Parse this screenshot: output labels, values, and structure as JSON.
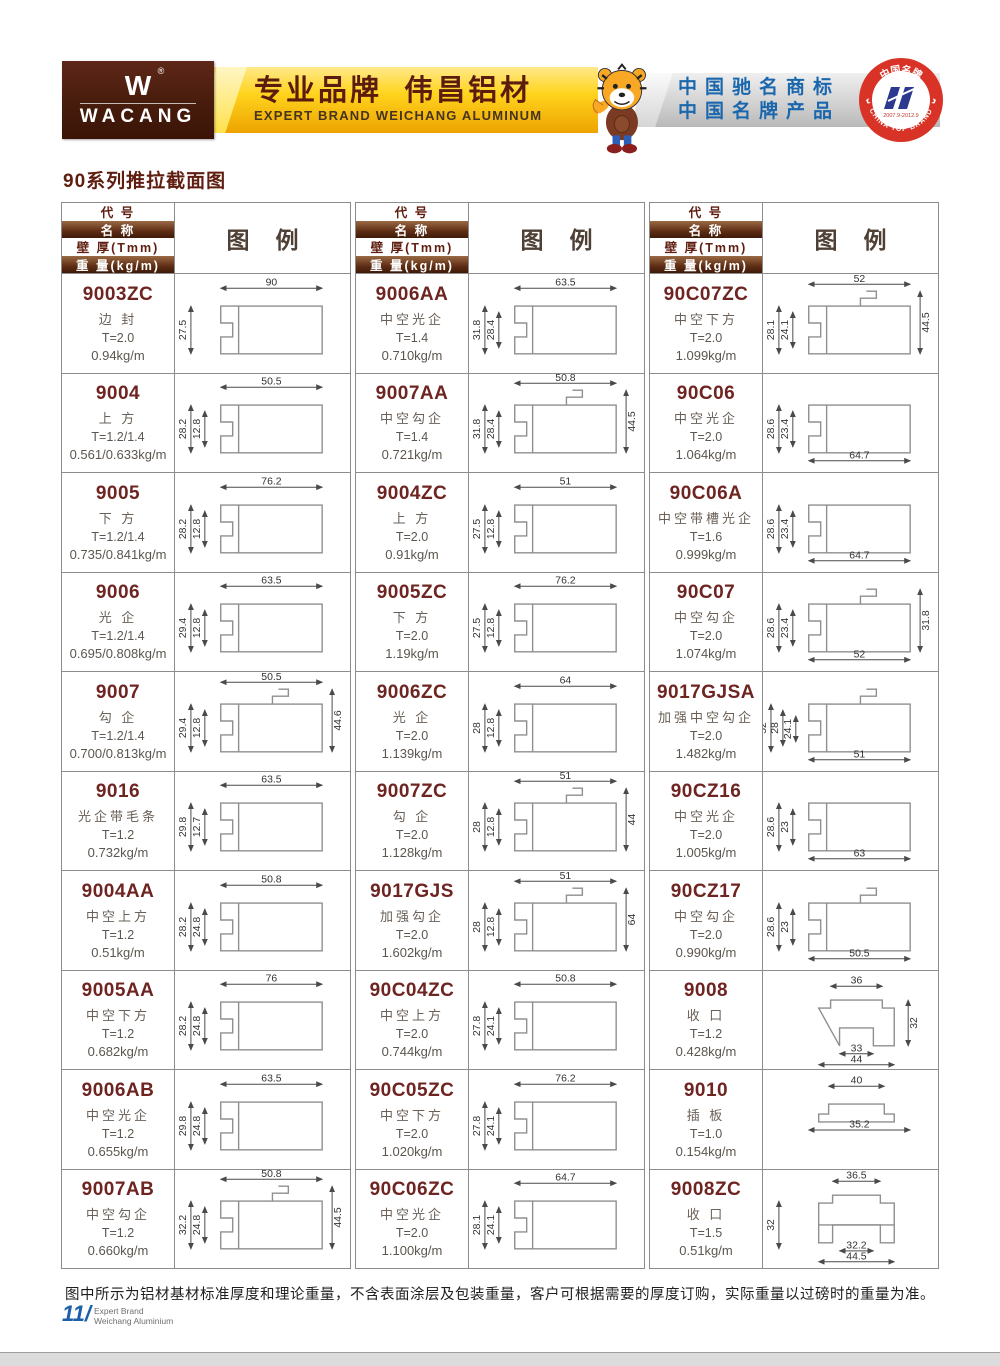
{
  "banner": {
    "logo": {
      "brand": "WACANG",
      "reg": "®"
    },
    "slogan_cn": "专业品牌  伟昌铝材",
    "slogan_en": "EXPERT BRAND WEICHANG ALUMINUM",
    "honors": [
      "中国驰名商标",
      "中国名牌产品"
    ],
    "badge": {
      "top": "中国名牌",
      "bottom": "CHINA TOP BRAND",
      "years": "2007.9-2012.9"
    }
  },
  "section_title": "90系列推拉截面图",
  "table": {
    "headers": {
      "code": "代  号",
      "name": "名  称",
      "thickness": "壁 厚(Tmm)",
      "weight": "重 量(kg/m)",
      "legend": "图例"
    },
    "columns": [
      {
        "products": [
          {
            "code": "9003ZC",
            "name": "边 封",
            "thickness": "T=2.0",
            "weight": "0.94kg/m",
            "shape": "frame",
            "dims": {
              "top": "90",
              "left": [
                "27.5"
              ]
            }
          },
          {
            "code": "9004",
            "name": "上 方",
            "thickness": "T=1.2/1.4",
            "weight": "0.561/0.633kg/m",
            "shape": "frame",
            "dims": {
              "top": "50.5",
              "left": [
                "28.2",
                "12.8"
              ]
            }
          },
          {
            "code": "9005",
            "name": "下 方",
            "thickness": "T=1.2/1.4",
            "weight": "0.735/0.841kg/m",
            "shape": "frame",
            "dims": {
              "top": "76.2",
              "left": [
                "28.2",
                "12.8"
              ]
            }
          },
          {
            "code": "9006",
            "name": "光 企",
            "thickness": "T=1.2/1.4",
            "weight": "0.695/0.808kg/m",
            "shape": "frame",
            "dims": {
              "top": "63.5",
              "left": [
                "29.4",
                "12.8"
              ]
            }
          },
          {
            "code": "9007",
            "name": "勾 企",
            "thickness": "T=1.2/1.4",
            "weight": "0.700/0.813kg/m",
            "shape": "hook",
            "dims": {
              "top": "50.5",
              "left": [
                "29.4",
                "12.8"
              ],
              "right": "44.6"
            }
          },
          {
            "code": "9016",
            "name": "光企带毛条",
            "thickness": "T=1.2",
            "weight": "0.732kg/m",
            "shape": "frame",
            "dims": {
              "top": "63.5",
              "left": [
                "29.8",
                "12.7"
              ]
            }
          },
          {
            "code": "9004AA",
            "name": "中空上方",
            "thickness": "T=1.2",
            "weight": "0.51kg/m",
            "shape": "frame",
            "dims": {
              "top": "50.8",
              "left": [
                "28.2",
                "24.8"
              ]
            }
          },
          {
            "code": "9005AA",
            "name": "中空下方",
            "thickness": "T=1.2",
            "weight": "0.682kg/m",
            "shape": "frame",
            "dims": {
              "top": "76",
              "left": [
                "28.2",
                "24.8"
              ]
            }
          },
          {
            "code": "9006AB",
            "name": "中空光企",
            "thickness": "T=1.2",
            "weight": "0.655kg/m",
            "shape": "frame",
            "dims": {
              "top": "63.5",
              "left": [
                "29.8",
                "24.8"
              ]
            }
          },
          {
            "code": "9007AB",
            "name": "中空勾企",
            "thickness": "T=1.2",
            "weight": "0.660kg/m",
            "shape": "hook",
            "dims": {
              "top": "50.8",
              "left": [
                "32.2",
                "24.8"
              ],
              "right": "44.5"
            }
          }
        ]
      },
      {
        "products": [
          {
            "code": "9006AA",
            "name": "中空光企",
            "thickness": "T=1.4",
            "weight": "0.710kg/m",
            "shape": "frame",
            "dims": {
              "top": "63.5",
              "left": [
                "31.8",
                "28.4"
              ]
            }
          },
          {
            "code": "9007AA",
            "name": "中空勾企",
            "thickness": "T=1.4",
            "weight": "0.721kg/m",
            "shape": "hook",
            "dims": {
              "top": "50.8",
              "left": [
                "31.8",
                "28.4"
              ],
              "right": "44.5"
            }
          },
          {
            "code": "9004ZC",
            "name": "上 方",
            "thickness": "T=2.0",
            "weight": "0.91kg/m",
            "shape": "frame",
            "dims": {
              "top": "51",
              "left": [
                "27.5",
                "12.8"
              ]
            }
          },
          {
            "code": "9005ZC",
            "name": "下 方",
            "thickness": "T=2.0",
            "weight": "1.19kg/m",
            "shape": "frame",
            "dims": {
              "top": "76.2",
              "left": [
                "27.5",
                "12.8"
              ]
            }
          },
          {
            "code": "9006ZC",
            "name": "光 企",
            "thickness": "T=2.0",
            "weight": "1.139kg/m",
            "shape": "frame",
            "dims": {
              "top": "64",
              "left": [
                "28",
                "12.8"
              ]
            }
          },
          {
            "code": "9007ZC",
            "name": "勾 企",
            "thickness": "T=2.0",
            "weight": "1.128kg/m",
            "shape": "hook",
            "dims": {
              "top": "51",
              "left": [
                "28",
                "12.8"
              ],
              "right": "44"
            }
          },
          {
            "code": "9017GJS",
            "name": "加强勾企",
            "thickness": "T=2.0",
            "weight": "1.602kg/m",
            "shape": "hook",
            "dims": {
              "top": "51",
              "left": [
                "28",
                "12.8"
              ],
              "right": "64"
            }
          },
          {
            "code": "90C04ZC",
            "name": "中空上方",
            "thickness": "T=2.0",
            "weight": "0.744kg/m",
            "shape": "frame",
            "dims": {
              "top": "50.8",
              "left": [
                "27.8",
                "24.1"
              ]
            }
          },
          {
            "code": "90C05ZC",
            "name": "中空下方",
            "thickness": "T=2.0",
            "weight": "1.020kg/m",
            "shape": "frame",
            "dims": {
              "top": "76.2",
              "left": [
                "27.8",
                "24.1"
              ]
            }
          },
          {
            "code": "90C06ZC",
            "name": "中空光企",
            "thickness": "T=2.0",
            "weight": "1.100kg/m",
            "shape": "frame",
            "dims": {
              "top": "64.7",
              "left": [
                "28.1",
                "24.1"
              ]
            }
          }
        ]
      },
      {
        "products": [
          {
            "code": "90C07ZC",
            "name": "中空下方",
            "thickness": "T=2.0",
            "weight": "1.099kg/m",
            "shape": "hook",
            "dims": {
              "top": "52",
              "left": [
                "28.1",
                "24.1"
              ],
              "right": "44.5"
            }
          },
          {
            "code": "90C06",
            "name": "中空光企",
            "thickness": "T=2.0",
            "weight": "1.064kg/m",
            "shape": "frame",
            "dims": {
              "left": [
                "28.6",
                "23.4"
              ],
              "bottom": [
                "64.7"
              ]
            }
          },
          {
            "code": "90C06A",
            "name": "中空带槽光企",
            "thickness": "T=1.6",
            "weight": "0.999kg/m",
            "shape": "frame",
            "dims": {
              "left": [
                "28.6",
                "23.4"
              ],
              "bottom": [
                "64.7"
              ]
            }
          },
          {
            "code": "90C07",
            "name": "中空勾企",
            "thickness": "T=2.0",
            "weight": "1.074kg/m",
            "shape": "hook",
            "dims": {
              "left": [
                "28.6",
                "23.4"
              ],
              "right": "31.8",
              "bottom": [
                "52"
              ]
            }
          },
          {
            "code": "9017GJSA",
            "name": "加强中空勾企",
            "thickness": "T=2.0",
            "weight": "1.482kg/m",
            "shape": "hook",
            "dims": {
              "left": [
                "52",
                "28",
                "24.1"
              ],
              "bottom": [
                "51"
              ]
            }
          },
          {
            "code": "90CZ16",
            "name": "中空光企",
            "thickness": "T=2.0",
            "weight": "1.005kg/m",
            "shape": "frame",
            "dims": {
              "left": [
                "28.6",
                "23"
              ],
              "bottom": [
                "63"
              ]
            }
          },
          {
            "code": "90CZ17",
            "name": "中空勾企",
            "thickness": "T=2.0",
            "weight": "0.990kg/m",
            "shape": "hook",
            "dims": {
              "left": [
                "28.6",
                "23"
              ],
              "bottom": [
                "50.5"
              ]
            }
          },
          {
            "code": "9008",
            "name": "收 口",
            "thickness": "T=1.2",
            "weight": "0.428kg/m",
            "shape": "hat",
            "dims": {
              "top": "36",
              "right": "32",
              "bottom": [
                "33",
                "44"
              ]
            }
          },
          {
            "code": "9010",
            "name": "插 板",
            "thickness": "T=1.0",
            "weight": "0.154kg/m",
            "shape": "tray",
            "dims": {
              "top": "40",
              "bottom": [
                "35.2"
              ]
            }
          },
          {
            "code": "9008ZC",
            "name": "收 口",
            "thickness": "T=1.5",
            "weight": "0.51kg/m",
            "shape": "hatz",
            "dims": {
              "top": "36.5",
              "left": [
                "32"
              ],
              "bottom": [
                "32.2",
                "44.5"
              ]
            }
          }
        ]
      }
    ]
  },
  "footer": {
    "note": "图中所示为铝材基材标准厚度和理论重量，不含表面涂层及包装重量，客户可根据需要的厚度订购，实际重量以过磅时的重量为准。",
    "page_no": "11",
    "page_slash": "/",
    "brand_line1": "Expert Brand",
    "brand_line2": "Weichang Aluminium"
  }
}
